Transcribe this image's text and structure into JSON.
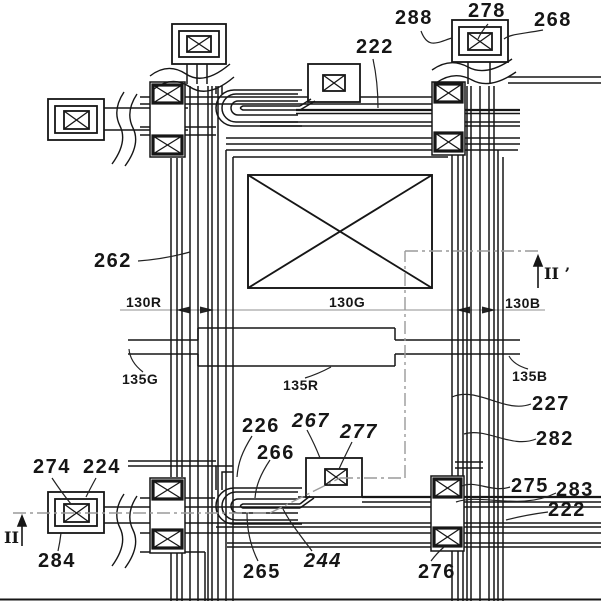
{
  "figure": {
    "kind": "patent-layout-drawing",
    "background_color": "#ffffff",
    "line_color": "#161616",
    "section_line_color": "#9a9a9a",
    "pixel_region_note": "crossed rectangle",
    "contact_note": "boxed-X contact pads"
  },
  "labels": [
    {
      "id": "ref-288",
      "text": "288"
    },
    {
      "id": "ref-278",
      "text": "278"
    },
    {
      "id": "ref-268",
      "text": "268"
    },
    {
      "id": "ref-222-top",
      "text": "222"
    },
    {
      "id": "ref-262",
      "text": "262"
    },
    {
      "id": "ref-130R",
      "text": "130R"
    },
    {
      "id": "ref-130G",
      "text": "130G"
    },
    {
      "id": "ref-130B",
      "text": "130B"
    },
    {
      "id": "ref-135G",
      "text": "135G"
    },
    {
      "id": "ref-135R",
      "text": "135R"
    },
    {
      "id": "ref-135B",
      "text": "135B"
    },
    {
      "id": "ref-227",
      "text": "227"
    },
    {
      "id": "ref-282",
      "text": "282"
    },
    {
      "id": "ref-226",
      "text": "226"
    },
    {
      "id": "ref-267",
      "text": "267"
    },
    {
      "id": "ref-277",
      "text": "277"
    },
    {
      "id": "ref-266",
      "text": "266"
    },
    {
      "id": "ref-274",
      "text": "274"
    },
    {
      "id": "ref-224",
      "text": "224"
    },
    {
      "id": "ref-275",
      "text": "275"
    },
    {
      "id": "ref-283",
      "text": "283"
    },
    {
      "id": "ref-222-bottom",
      "text": "222"
    },
    {
      "id": "ref-284",
      "text": "284"
    },
    {
      "id": "ref-265",
      "text": "265"
    },
    {
      "id": "ref-244",
      "text": "244"
    },
    {
      "id": "ref-276",
      "text": "276"
    },
    {
      "id": "section-II",
      "text": "II"
    },
    {
      "id": "section-II-prime",
      "text": "II ’"
    }
  ]
}
